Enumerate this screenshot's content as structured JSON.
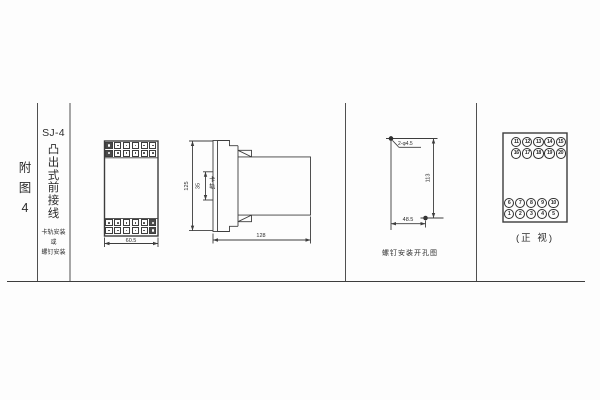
{
  "sheet": {
    "figure_label_chars": [
      "附",
      "图",
      "4"
    ],
    "model": "SJ-4",
    "title_chars": [
      "凸",
      "出",
      "式",
      "前",
      "接",
      "线"
    ],
    "mount_note_lines": [
      "卡轨安装",
      "或",
      "螺钉安装"
    ]
  },
  "front_view": {
    "width_dim": "60.5"
  },
  "side_view": {
    "height_dim": "125",
    "rail_width_dim": "35",
    "rail_label": "卡轨",
    "depth_dim": "128"
  },
  "drill_view": {
    "holes_label": "2-φ4.5",
    "vertical_dim": "113",
    "horizontal_dim": "48.5",
    "caption": "螺钉安装开孔图"
  },
  "terminal_view": {
    "top_rows": [
      [
        "11",
        "12",
        "13",
        "14",
        "15"
      ],
      [
        "16",
        "17",
        "18",
        "19",
        "20"
      ]
    ],
    "bottom_rows": [
      [
        "6",
        "7",
        "8",
        "9",
        "10"
      ],
      [
        "1",
        "2",
        "3",
        "4",
        "5"
      ]
    ],
    "caption": "(正 视)"
  },
  "colors": {
    "line": "#3d3d3d",
    "text": "#2b2b2b"
  }
}
